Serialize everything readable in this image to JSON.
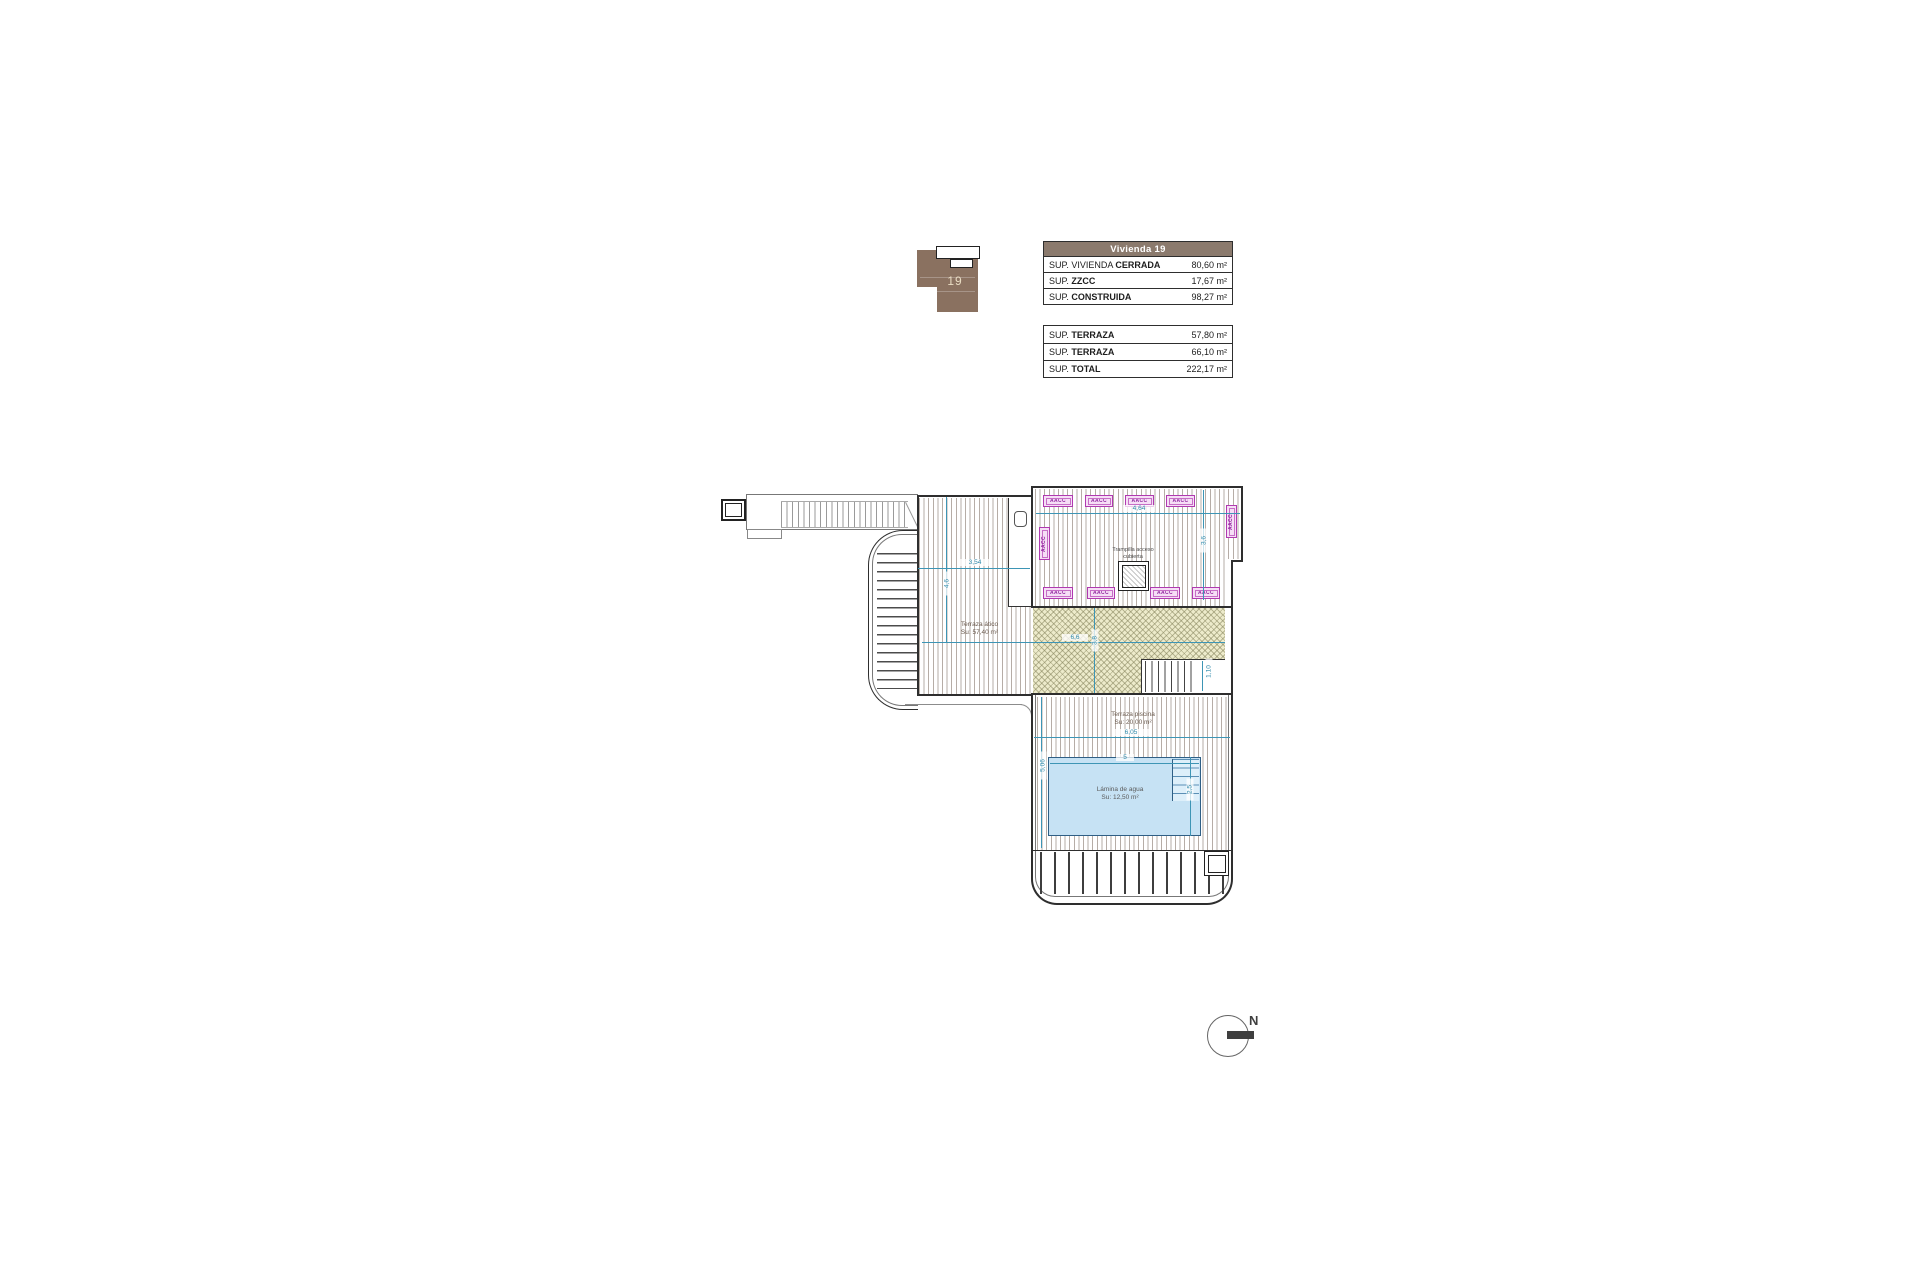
{
  "key_plan": {
    "unit_number": "19"
  },
  "tables": {
    "summary": {
      "header": "Vivienda 19",
      "rows": [
        {
          "prefix": "SUP. VIVIENDA ",
          "bold": "CERRADA",
          "value": "80,60 m²"
        },
        {
          "prefix": "SUP. ",
          "bold": "ZZCC",
          "value": "17,67 m²"
        },
        {
          "prefix": "SUP. ",
          "bold": "CONSTRUIDA",
          "value": "98,27 m²"
        }
      ]
    },
    "terraces": {
      "rows": [
        {
          "prefix": "SUP. ",
          "bold": "TERRAZA",
          "value": "57,80 m²"
        },
        {
          "prefix": "SUP. ",
          "bold": "TERRAZA",
          "value": "66,10 m²"
        },
        {
          "prefix": "SUP. ",
          "bold": "TOTAL",
          "value": "222,17 m²"
        }
      ]
    }
  },
  "plan": {
    "aacc_label": "AACC",
    "roof_hatch_label": {
      "line1": "Trampilla acceso",
      "line2": "cubierta"
    },
    "terraza_atico": {
      "line1": "Terraza ático",
      "line2": "Su: 57,40 m²"
    },
    "terraza_piscina": {
      "line1": "Terraza piscina",
      "line2": "Su: 20,00 m²"
    },
    "lamina_agua": {
      "line1": "Lámina de agua",
      "line2": "Su: 12,50 m²"
    },
    "dims": {
      "atico_width": "3,54",
      "atico_height": "4,6",
      "right_terrace_width": "4,64",
      "right_terrace_height": "3,6",
      "khaki_width": "6,6",
      "khaki_height": "3,8",
      "stairs_width": "1,10",
      "pool_terrace_width": "6,05",
      "pool_terrace_height": "5,06",
      "pool_width": "5",
      "pool_steps": "2,5"
    },
    "compass": {
      "north_label": "N"
    }
  },
  "colors": {
    "table_header_bg": "#8b7a6d",
    "keyplan_brown": "#8a7160",
    "keyplan_number": "#e9dcc3",
    "aacc_purple": "#b03ab0",
    "dimension_teal": "#3D95B5",
    "pool_fill": "#c6e2f4",
    "pool_border": "#2f5f85",
    "khaki_fill": "#edebcb",
    "wall_dark": "#2e2e2e"
  }
}
